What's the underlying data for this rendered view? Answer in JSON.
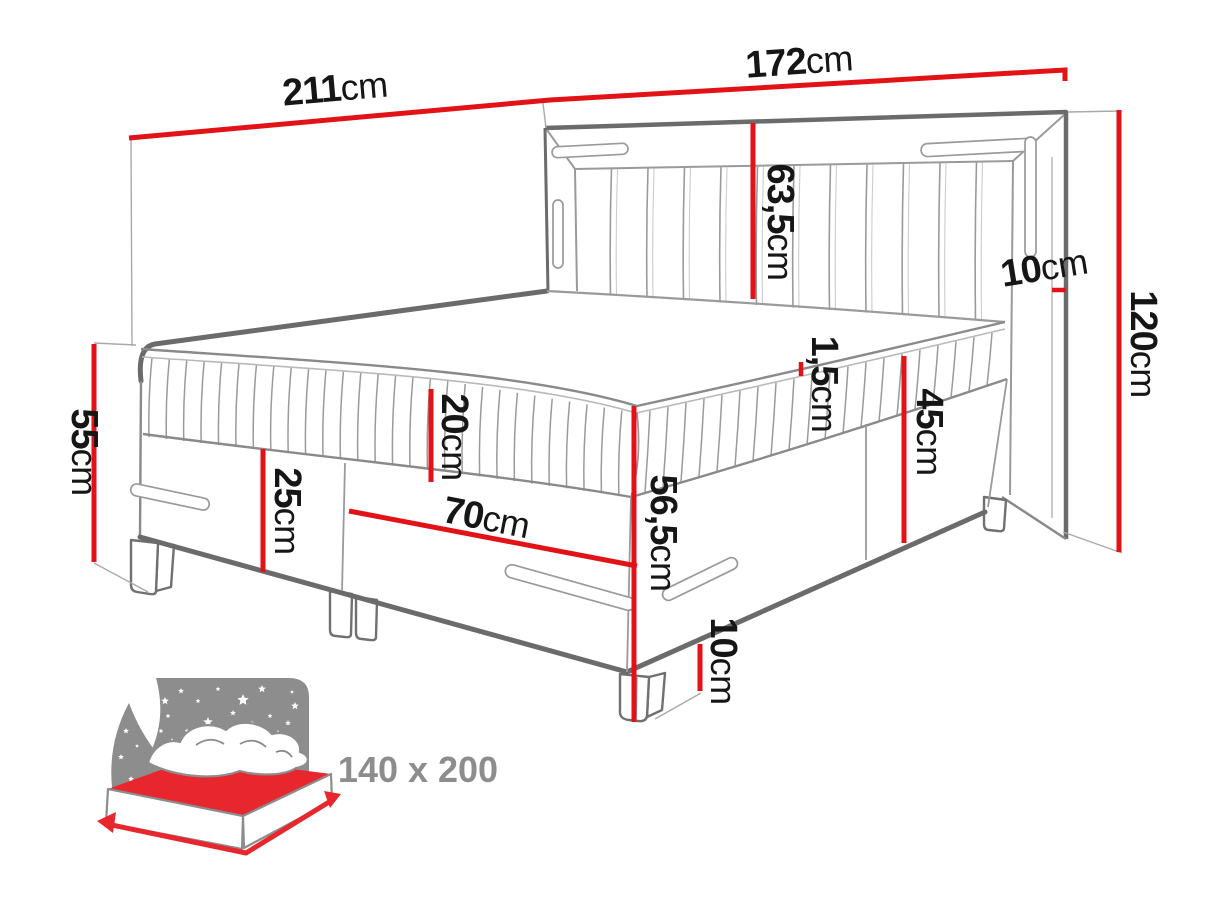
{
  "dims": {
    "w211": {
      "value": "211",
      "unit": "cm"
    },
    "w172": {
      "value": "172",
      "unit": "cm"
    },
    "h63_5": {
      "value": "63,5",
      "unit": "cm"
    },
    "t10": {
      "value": "10",
      "unit": "cm"
    },
    "h120": {
      "value": "120",
      "unit": "cm"
    },
    "h55": {
      "value": "55",
      "unit": "cm"
    },
    "h20": {
      "value": "20",
      "unit": "cm"
    },
    "h25": {
      "value": "25",
      "unit": "cm"
    },
    "w70": {
      "value": "70",
      "unit": "cm"
    },
    "h1_5": {
      "value": "1,5",
      "unit": "cm"
    },
    "h45": {
      "value": "45",
      "unit": "cm"
    },
    "h56_5": {
      "value": "56,5",
      "unit": "cm"
    },
    "leg10": {
      "value": "10",
      "unit": "cm"
    }
  },
  "badge": {
    "size_text": "140 x 200"
  },
  "colors": {
    "dimension_red": "#e21217",
    "icon_red": "#e8262d",
    "icon_gray": "#8d8d8d",
    "outline_dark": "#6b6b6b",
    "outline_mid": "#8a8a8a",
    "outline_light": "#9a9a9a",
    "label_text": "#161616"
  }
}
